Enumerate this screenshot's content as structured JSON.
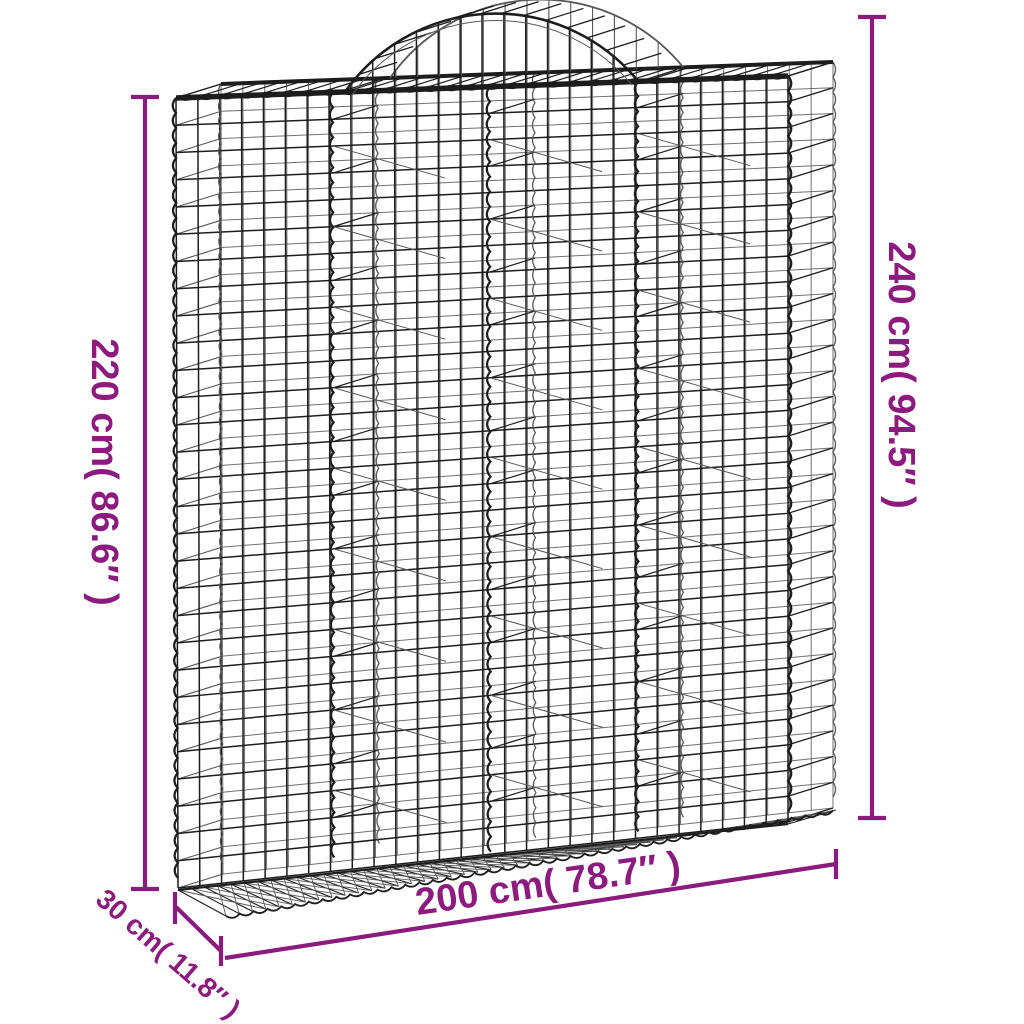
{
  "diagram": {
    "subject": "arched gabion wire mesh basket",
    "dimensions": {
      "height_left": {
        "text": "220 cm( 86.6″ )",
        "value_cm": 220,
        "value_in": 86.6
      },
      "height_right": {
        "text": "240 cm( 94.5″ )",
        "value_cm": 240,
        "value_in": 94.5
      },
      "width_bottom": {
        "text": "200 cm( 78.7″ )",
        "value_cm": 200,
        "value_in": 78.7
      },
      "depth": {
        "text": "30 cm( 11.8″ )",
        "value_cm": 30,
        "value_in": 11.8
      }
    },
    "colors": {
      "annotation": "#8b1b7d",
      "wire_dark": "#1d1d1d",
      "wire_light": "#585858",
      "background": "#ffffff"
    }
  }
}
